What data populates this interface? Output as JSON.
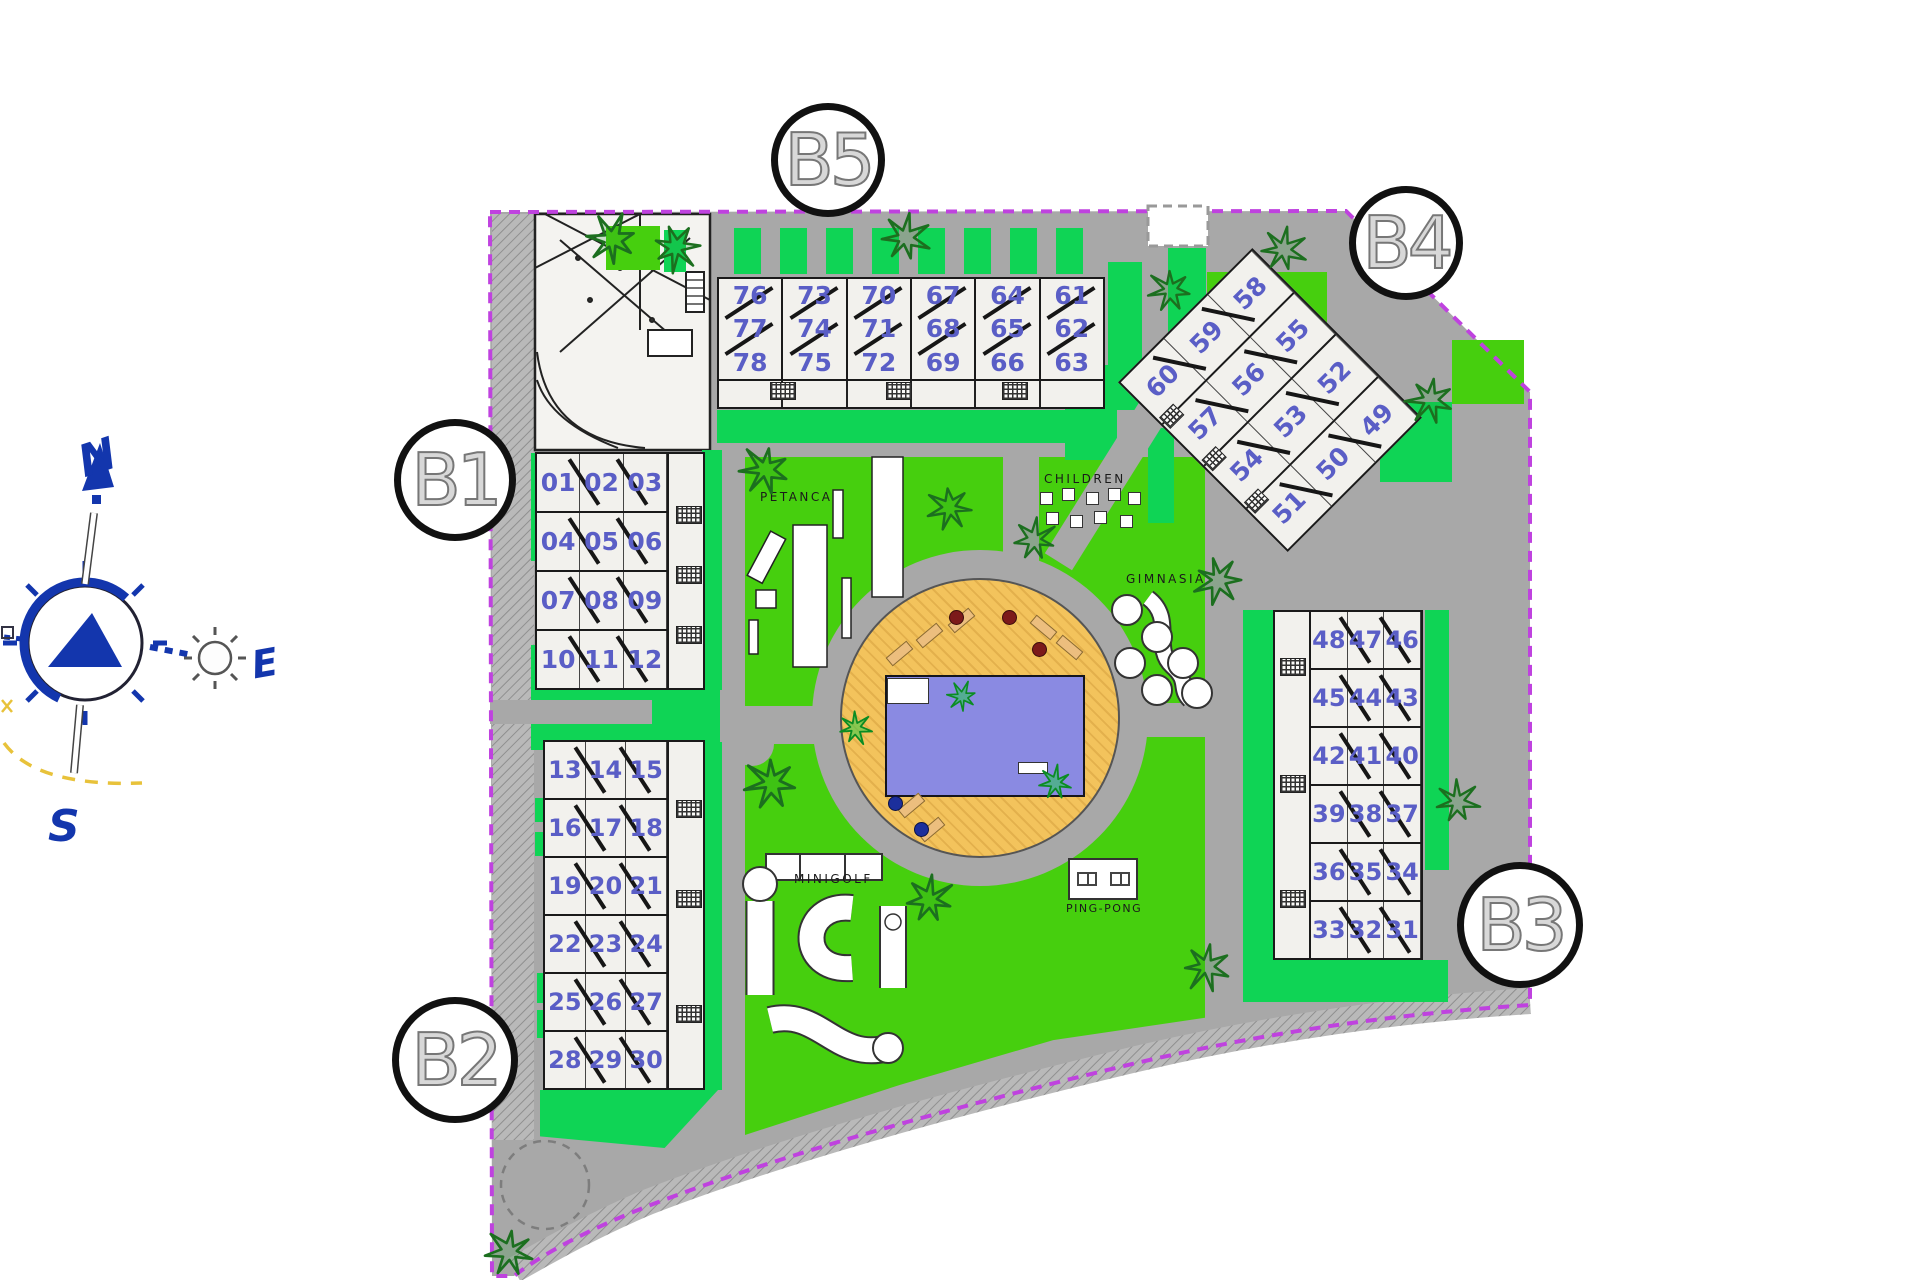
{
  "compass": {
    "north": "N",
    "east": "E",
    "south": "S"
  },
  "block_labels": {
    "b1": "B1",
    "b2": "B2",
    "b3": "B3",
    "b4": "B4",
    "b5": "B5"
  },
  "buildings": {
    "b5": {
      "block": "B5",
      "columns": [
        [
          "76",
          "77",
          "78"
        ],
        [
          "73",
          "74",
          "75"
        ],
        [
          "70",
          "71",
          "72"
        ],
        [
          "67",
          "68",
          "69"
        ],
        [
          "64",
          "65",
          "66"
        ],
        [
          "61",
          "62",
          "63"
        ]
      ]
    },
    "b4": {
      "block": "B4",
      "rows": [
        [
          "60",
          "59",
          "58"
        ],
        [
          "57",
          "56",
          "55"
        ],
        [
          "54",
          "53",
          "52"
        ],
        [
          "51",
          "50",
          "49"
        ]
      ]
    },
    "b1": {
      "block": "B1",
      "rows": [
        [
          "01",
          "02",
          "03"
        ],
        [
          "04",
          "05",
          "06"
        ],
        [
          "07",
          "08",
          "09"
        ],
        [
          "10",
          "11",
          "12"
        ]
      ]
    },
    "b2": {
      "block": "B2",
      "rows": [
        [
          "13",
          "14",
          "15"
        ],
        [
          "16",
          "17",
          "18"
        ],
        [
          "19",
          "20",
          "21"
        ],
        [
          "22",
          "23",
          "24"
        ],
        [
          "25",
          "26",
          "27"
        ],
        [
          "28",
          "29",
          "30"
        ]
      ]
    },
    "b3": {
      "block": "B3",
      "rows": [
        [
          "48",
          "47",
          "46"
        ],
        [
          "45",
          "44",
          "43"
        ],
        [
          "42",
          "41",
          "40"
        ],
        [
          "39",
          "38",
          "37"
        ],
        [
          "36",
          "35",
          "34"
        ],
        [
          "33",
          "32",
          "31"
        ]
      ]
    }
  },
  "amenities": {
    "petanca": "PETANCA",
    "children": "CHILDREN",
    "gimnasia": "GIMNASIA",
    "minigolf": "MINIGOLF",
    "ping_pong": "PING-PONG"
  },
  "colors": {
    "boundary": "#bf42df",
    "lawn": "#46cf0e",
    "garden_green": "#0fd455",
    "road_gray": "#a8a8a8",
    "deck_orange": "#f3c35c",
    "pool_blue": "#8a8ae2",
    "unit_number_blue": "#5a5ec6",
    "compass_blue": "#1336ad"
  }
}
